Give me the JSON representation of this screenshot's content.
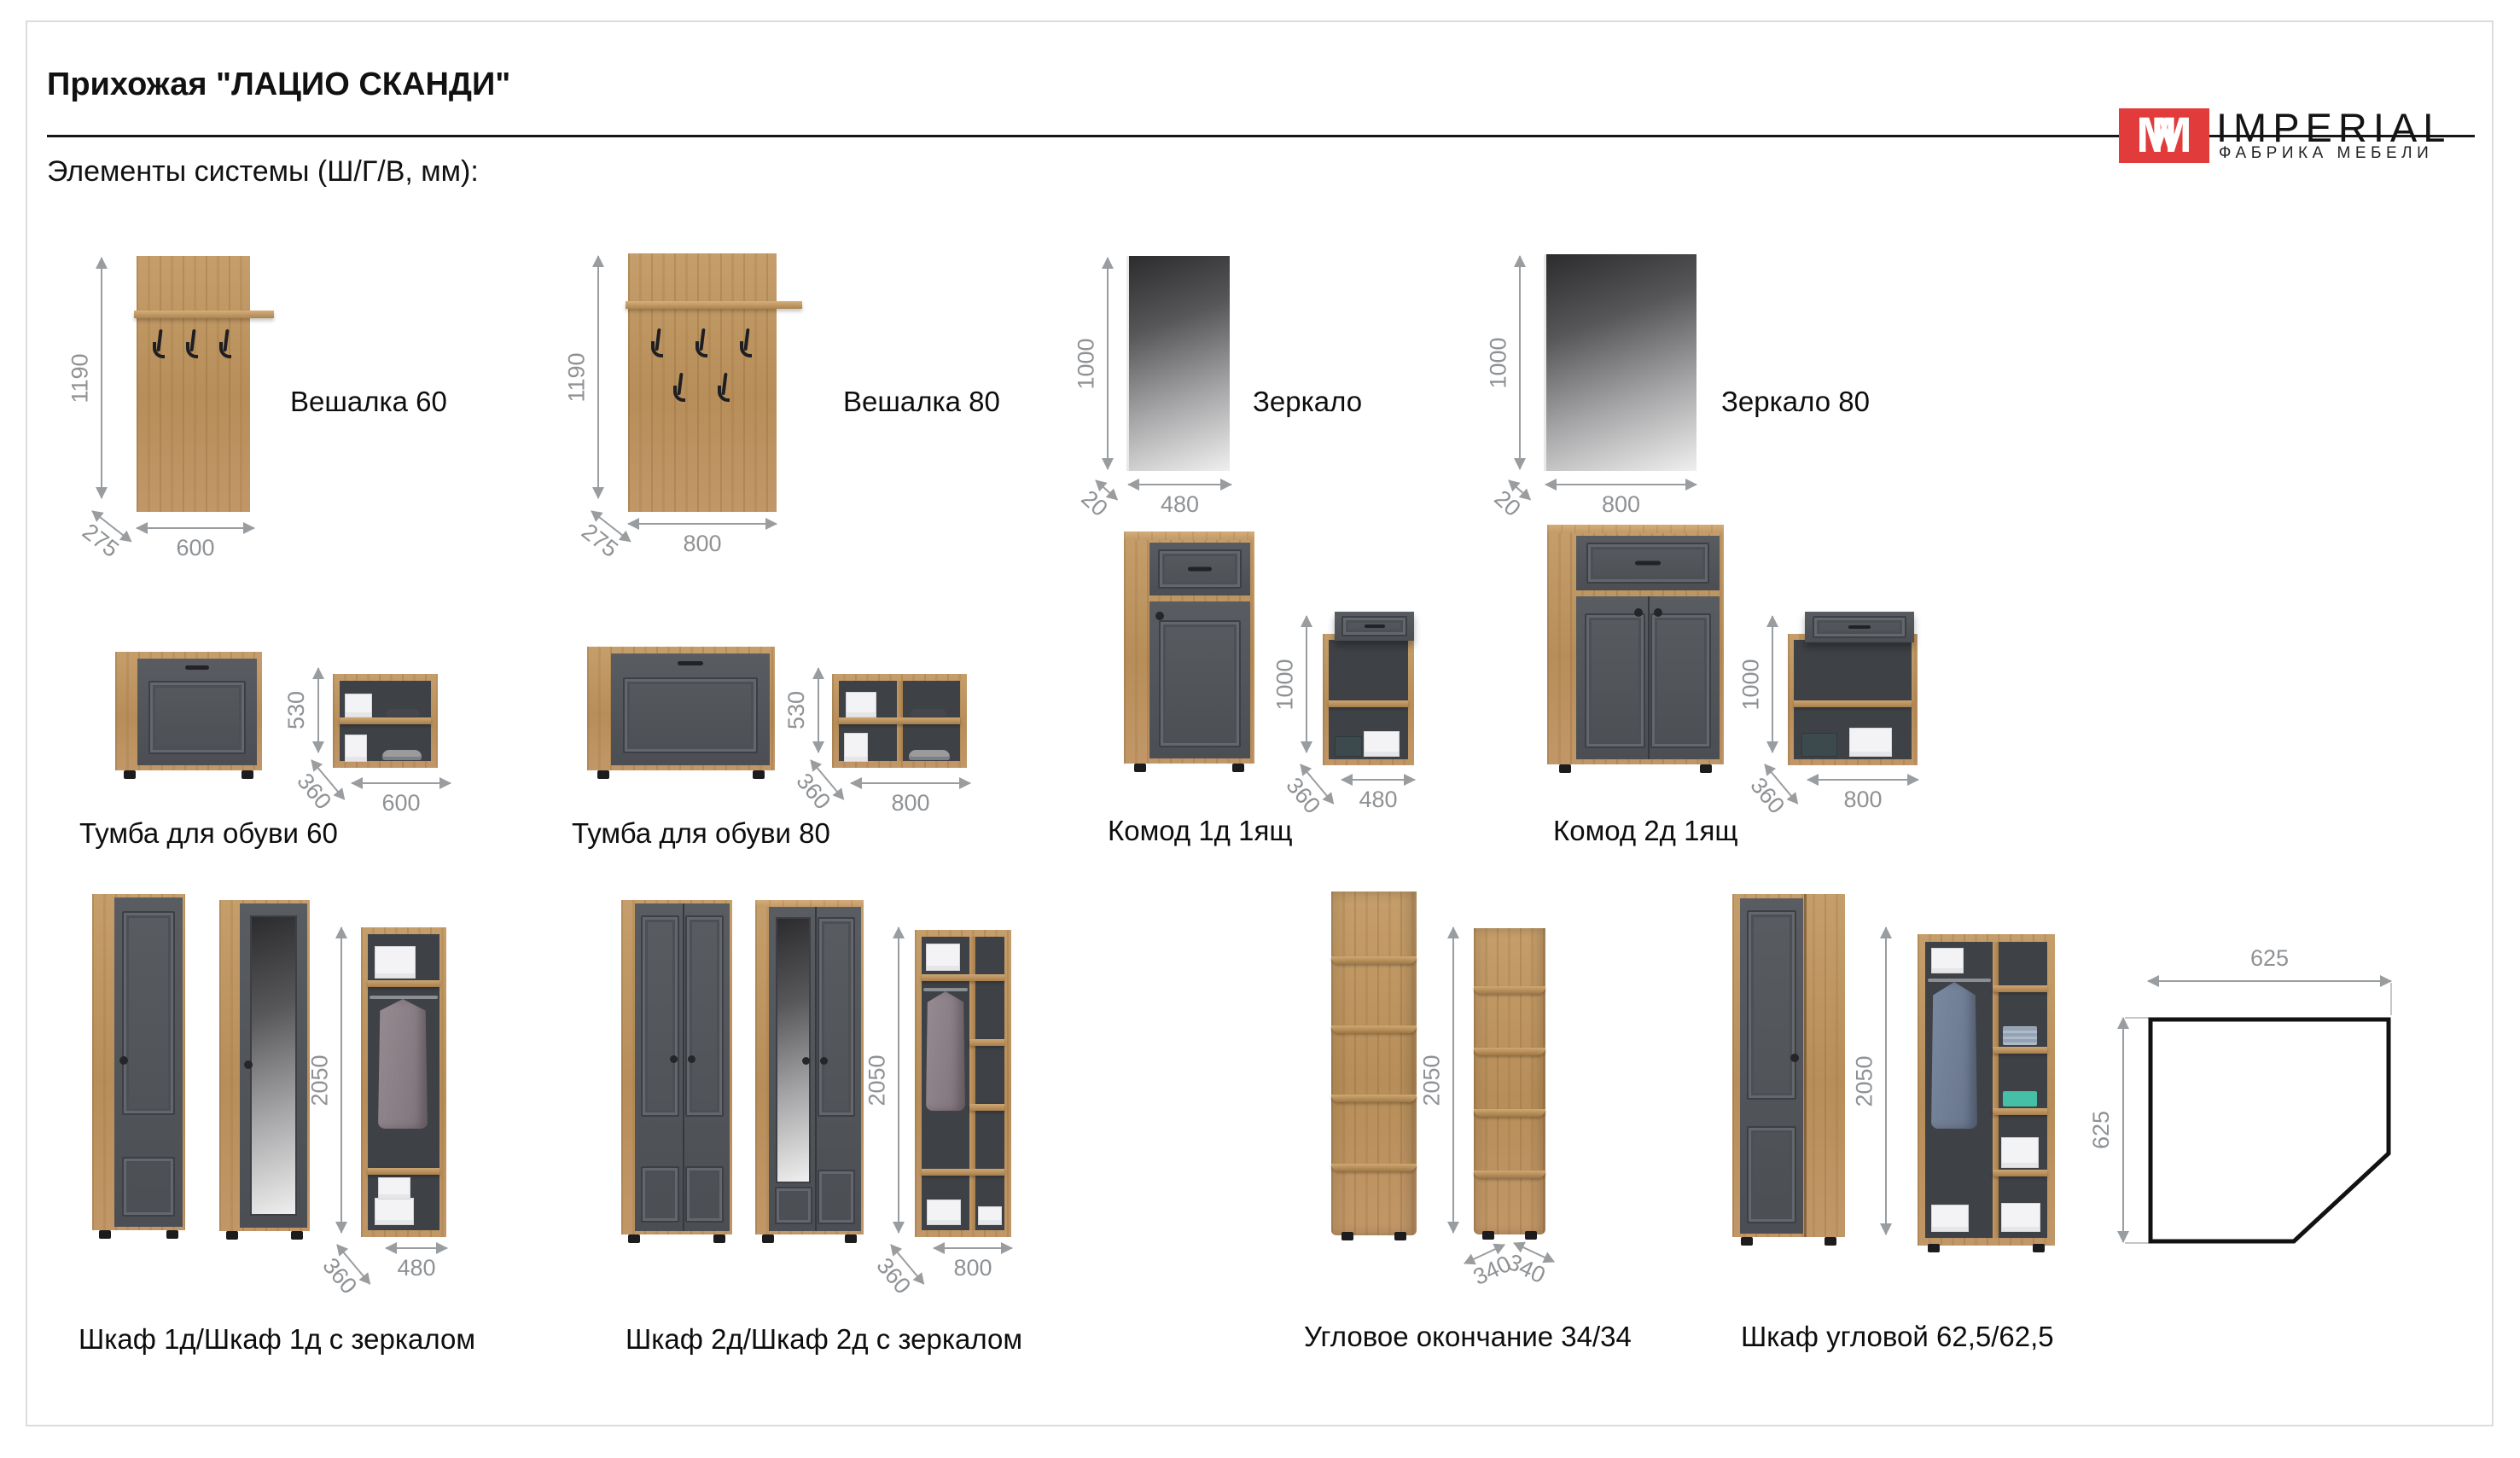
{
  "page": {
    "title": "Прихожая \"ЛАЦИО СКАНДИ\"",
    "subtitle": "Элементы системы (Ш/Г/В, мм):",
    "logo": {
      "mark": "M",
      "name": "IMPERIAL",
      "tagline": "ФАБРИКА МЕБЕЛИ",
      "brand_red": "#e23b3b"
    }
  },
  "colors": {
    "wood": "#bb9260",
    "front_gray": "#515459",
    "dim_gray": "#8f9295",
    "accent_red": "#e23b3b"
  },
  "items": {
    "veshalka60": {
      "label": "Вешалка 60",
      "height": "1190",
      "depth": "275",
      "width": "600"
    },
    "veshalka80": {
      "label": "Вешалка 80",
      "height": "1190",
      "depth": "275",
      "width": "800"
    },
    "zerkalo": {
      "label": "Зеркало",
      "height": "1000",
      "depth": "20",
      "width": "480"
    },
    "zerkalo80": {
      "label": "Зеркало 80",
      "height": "1000",
      "depth": "20",
      "width": "800"
    },
    "tumba60": {
      "label": "Тумба для обуви 60",
      "height": "530",
      "depth": "360",
      "width": "600"
    },
    "tumba80": {
      "label": "Тумба для обуви 80",
      "height": "530",
      "depth": "360",
      "width": "800"
    },
    "komod1": {
      "label": "Комод 1д 1ящ",
      "height": "1000",
      "depth": "360",
      "width": "480"
    },
    "komod2": {
      "label": "Комод 2д 1ящ",
      "height": "1000",
      "depth": "360",
      "width": "800"
    },
    "shkaf1": {
      "label": "Шкаф 1д/Шкаф 1д с зеркалом",
      "height": "2050",
      "depth": "360",
      "width": "480"
    },
    "shkaf2": {
      "label": "Шкаф 2д/Шкаф 2д с зеркалом",
      "height": "2050",
      "depth": "360",
      "width": "800"
    },
    "uglovoe": {
      "label": "Угловое окончание 34/34",
      "height": "2050",
      "width_left": "340",
      "width_right": "340"
    },
    "shkaf_uglovoy": {
      "label": "Шкаф угловой 62,5/62,5",
      "height": "2050",
      "plan_width": "625",
      "plan_depth": "625"
    }
  }
}
